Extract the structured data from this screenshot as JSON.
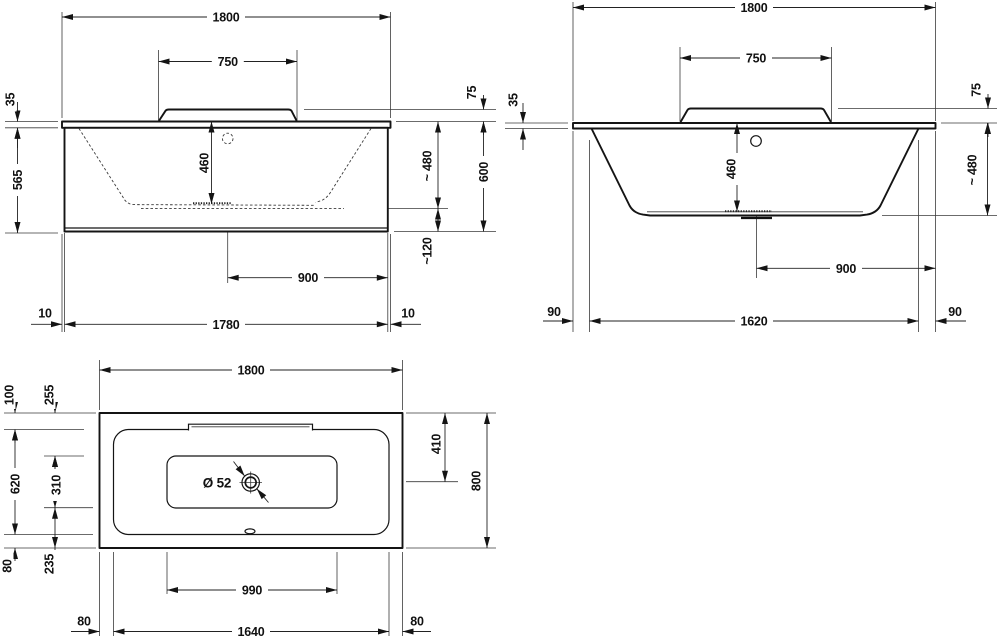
{
  "colors": {
    "ink": "#141414",
    "paper": "#ffffff"
  },
  "front": {
    "width": "1800",
    "backrest": "750",
    "rim": "35",
    "backrest_height": "75",
    "apron": "565",
    "depth": "460",
    "floor_height": "~ 480",
    "height": "600",
    "clearance": "~120",
    "drain": "900",
    "inset_l": "10",
    "apron_w": "1780",
    "inset_r": "10"
  },
  "side": {
    "width": "1800",
    "backrest": "750",
    "rim": "35",
    "backrest_height": "75",
    "depth": "460",
    "floor_height": "~ 480",
    "drain": "900",
    "foot_l": "90",
    "feet_span": "1620",
    "foot_r": "90"
  },
  "plan": {
    "length": "1800",
    "rim_top": "100",
    "ledge_top": "255",
    "inner_w": "620",
    "floor_w": "310",
    "rim_bottom": "80",
    "ledge_bottom": "235",
    "drain_y": "410",
    "width": "800",
    "drain_dia": "Ø 52",
    "floor_l": "990",
    "rim_l": "80",
    "inner_l": "1640",
    "rim_r": "80"
  }
}
